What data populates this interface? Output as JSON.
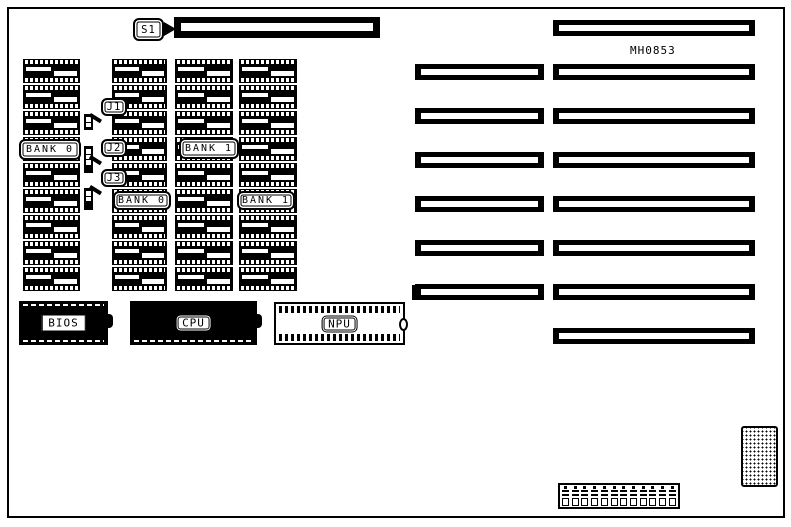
{
  "diagram": {
    "part_number": "MH0853",
    "switch": {
      "label": "S1"
    },
    "jumpers": [
      {
        "label": "J1",
        "cells": [
          "open",
          "open"
        ]
      },
      {
        "label": "J2",
        "cells": [
          "open",
          "open",
          "open",
          "closed"
        ]
      },
      {
        "label": "J3",
        "cells": [
          "open",
          "open",
          "closed"
        ]
      }
    ],
    "memory": {
      "columns": 4,
      "chips_per_column": 9,
      "bank_labels": [
        {
          "label": "BANK 0"
        },
        {
          "label": "BANK 1"
        },
        {
          "label": "BANK 0"
        },
        {
          "label": "BANK 1"
        }
      ]
    },
    "chips": {
      "bios": "BIOS",
      "cpu": "CPU",
      "npu": "NPU"
    },
    "expansion_slots": {
      "left_column_count": 6,
      "right_column_count": 8
    },
    "power_connector": {
      "pins": 12
    },
    "colors": {
      "ink": "#000000",
      "background": "#ffffff"
    }
  }
}
